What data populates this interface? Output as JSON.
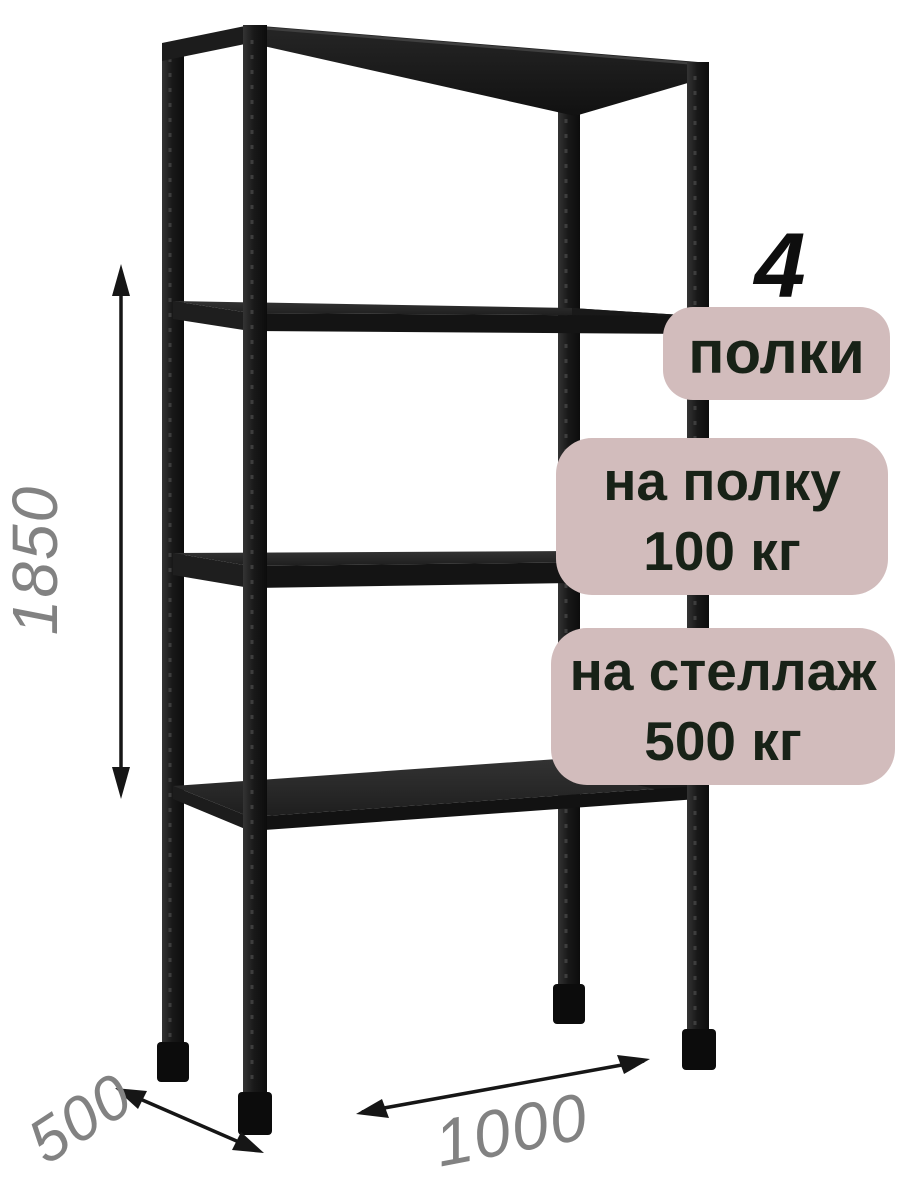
{
  "badges": {
    "count_number": "4",
    "count_label": "полки",
    "per_shelf": {
      "line1": "на полку",
      "line2": "100 кг"
    },
    "per_rack": {
      "line1": "на стеллаж",
      "line2": "500 кг"
    }
  },
  "dimensions": {
    "height": "1850",
    "depth": "500",
    "width": "1000"
  },
  "colors": {
    "background": "#ffffff",
    "badge_background": "#d2bcbc",
    "badge_text": "#182217",
    "metal_dark": "#1a1a1a",
    "dimension_text": "#828282",
    "arrow": "#161616"
  }
}
